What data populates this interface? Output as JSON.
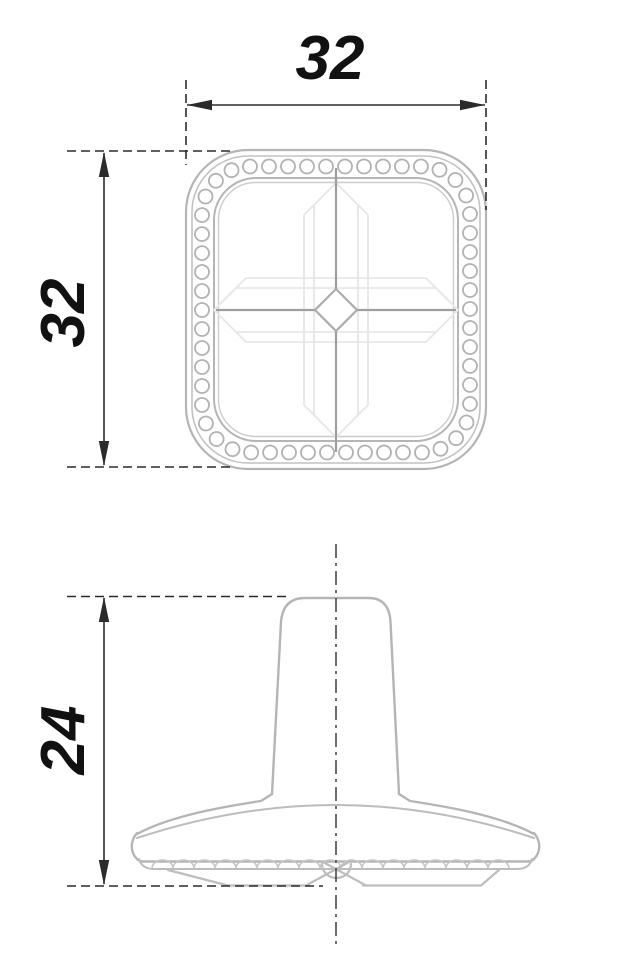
{
  "drawing": {
    "dimensions": {
      "top_width": "32",
      "top_height": "32",
      "side_height": "24"
    },
    "colors": {
      "dimension_ink": "#2b2b2b",
      "centerline_ink": "#3c3c3c",
      "part_outline": "#b5b5b5",
      "part_secondary": "#c2c2c2",
      "part_detail": "#c6c6c6",
      "facet_light": "#e7e7e7",
      "facet_mid": "#9e9e9e",
      "background": "#ffffff"
    },
    "top_view": {
      "bead_count": 54
    },
    "side_view": {
      "scallop_count": 17
    }
  }
}
